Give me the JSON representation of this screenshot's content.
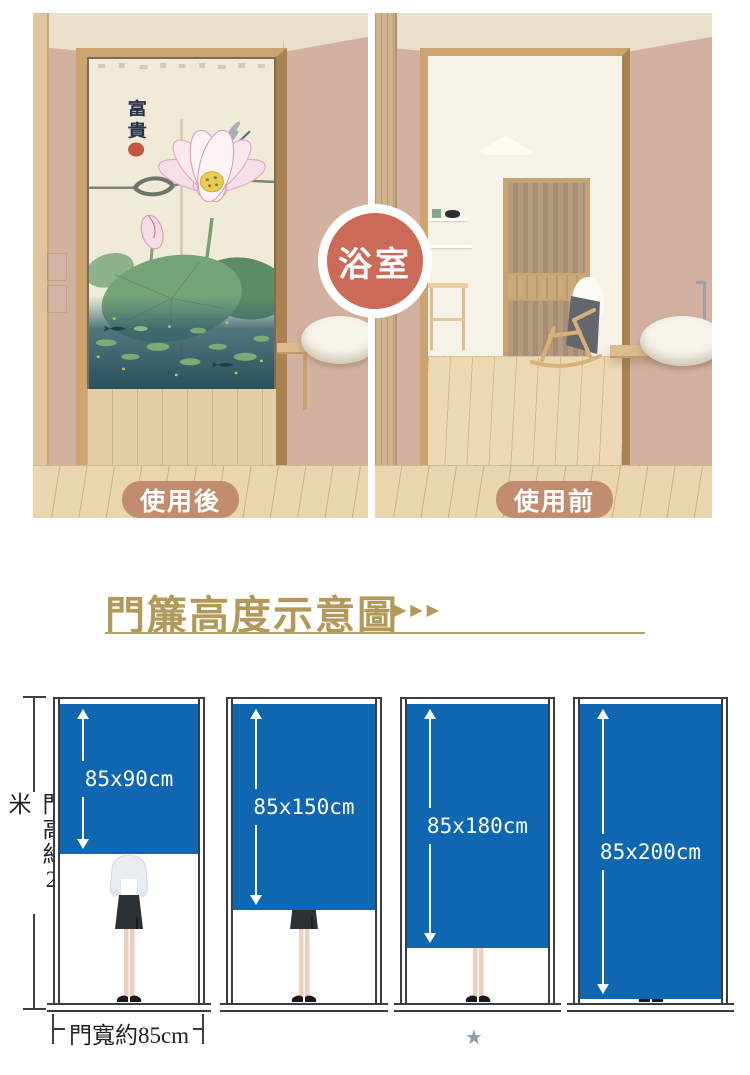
{
  "comparison": {
    "badge_label": "浴室",
    "after_label": "使用後",
    "before_label": "使用前",
    "calligraphy_top": "富",
    "calligraphy_bottom": "貴"
  },
  "section": {
    "title": "門簾高度示意圖",
    "arrows": "▶▶▶"
  },
  "diagram": {
    "height_label": "門高約2米",
    "width_label": "門寬約85cm",
    "sizes": [
      {
        "label": "85x90cm"
      },
      {
        "label": "85x150cm"
      },
      {
        "label": "85x180cm"
      },
      {
        "label": "85x200cm"
      }
    ],
    "star": "★"
  },
  "colors": {
    "accent_gold": "#b2995a",
    "curtain_blue": "#0e67b0",
    "badge_red": "#cb6a58",
    "pill_tan": "#c28d6e",
    "star_gray": "#8c9ba8"
  }
}
